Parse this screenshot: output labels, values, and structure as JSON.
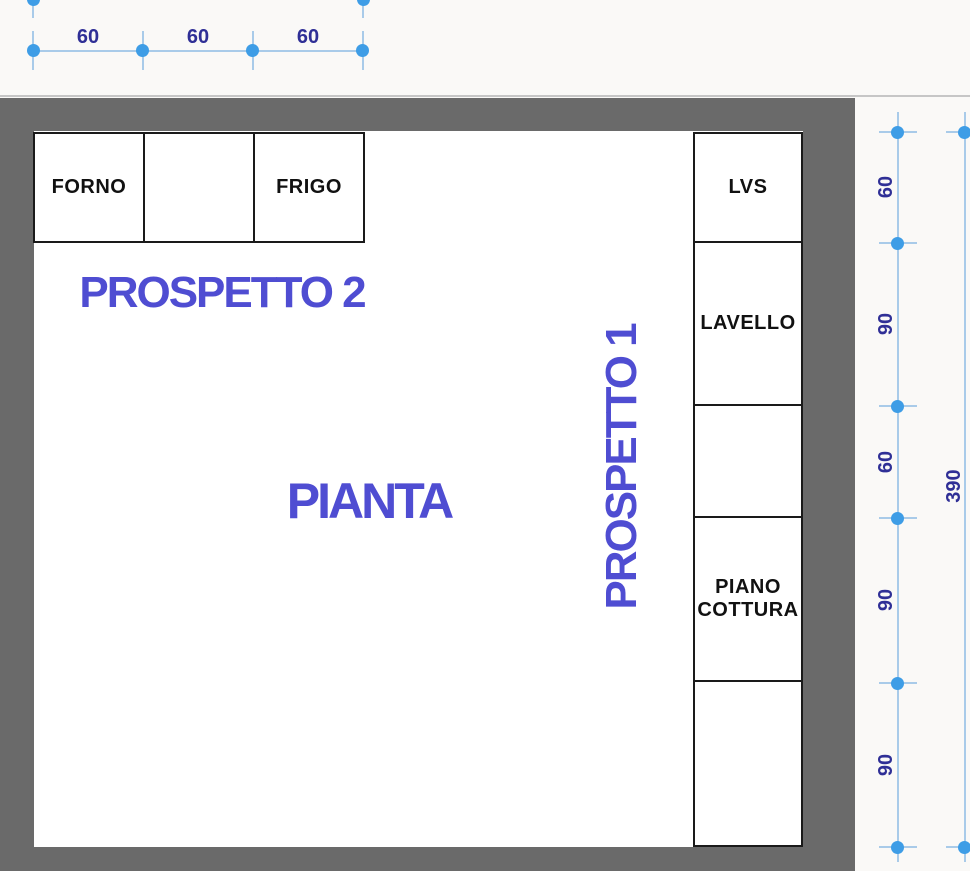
{
  "colors": {
    "bg": "#FAF9F7",
    "interior": "#FFFFFF",
    "wall": "#6A6A6A",
    "hairline": "#C6C6C6",
    "box_border": "#1A1A1A",
    "box_text": "#111111",
    "accent": "#4F4DD2",
    "dim_text": "#2F2F96",
    "marker": "#3E9DE6",
    "dim_line": "#A9CBE9"
  },
  "top_dimension": {
    "segments": [
      "60",
      "60",
      "60"
    ]
  },
  "plan": {
    "labels": {
      "pianta": "PIANTA",
      "prospetto1": "PROSPETTO 1",
      "prospetto2": "PROSPETTO 2"
    },
    "top_row_units": [
      {
        "label": "FORNO"
      },
      {
        "label": ""
      },
      {
        "label": "FRIGO"
      }
    ],
    "right_column_units": [
      {
        "label": "LVS"
      },
      {
        "label": "LAVELLO"
      },
      {
        "label": ""
      },
      {
        "label": "PIANO COTTURA"
      },
      {
        "label": ""
      }
    ]
  },
  "right_dimension": {
    "segments": [
      "60",
      "90",
      "60",
      "90",
      "90"
    ],
    "total": "390"
  }
}
